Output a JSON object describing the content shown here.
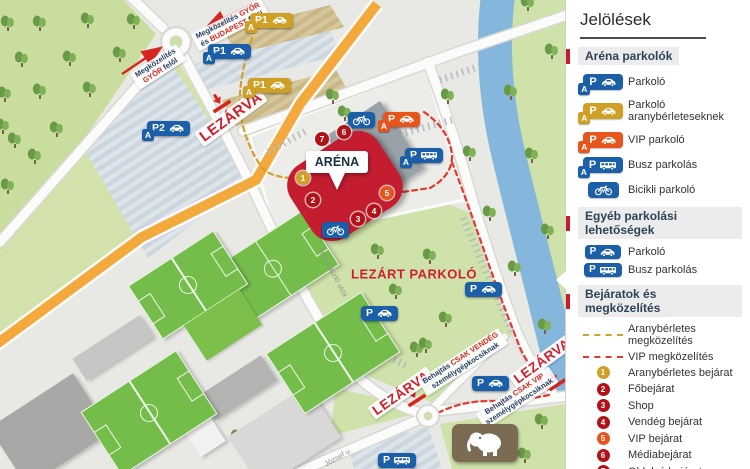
{
  "colors": {
    "blue": "#1a5fa8",
    "gold": "#d09f25",
    "orange": "#e8551c",
    "darkred": "#b01218",
    "red_text": "#cf1f2d",
    "river": "#84b7db",
    "grass": "#cfe2a9",
    "forest": "#c9dd9f",
    "road_orange": "#f3a93c",
    "brown": "#7b6b52"
  },
  "legend": {
    "title": "Jelölések",
    "sections": [
      {
        "header": "Aréna parkolók",
        "items": [
          {
            "type": "sign",
            "color": "blue",
            "p": "P",
            "glyph": "car",
            "badge": "A",
            "label": "Parkoló"
          },
          {
            "type": "sign",
            "color": "gold",
            "p": "P",
            "glyph": "car",
            "badge": "A",
            "label": "Parkoló aranybérleteseknek"
          },
          {
            "type": "sign",
            "color": "orange",
            "p": "P",
            "glyph": "car",
            "badge": "A",
            "label": "VIP parkoló"
          },
          {
            "type": "sign",
            "color": "blue",
            "p": "P",
            "glyph": "bus",
            "badge": "A",
            "label": "Busz parkolás"
          },
          {
            "type": "sign",
            "color": "blue",
            "p": "",
            "glyph": "bike",
            "badge": null,
            "label": "Bicikli parkoló"
          }
        ]
      },
      {
        "header": "Egyéb parkolási lehetőségek",
        "items": [
          {
            "type": "sign",
            "color": "blue",
            "p": "P",
            "glyph": "car",
            "badge": null,
            "label": "Parkoló"
          },
          {
            "type": "sign",
            "color": "blue",
            "p": "P",
            "glyph": "bus",
            "badge": null,
            "label": "Busz parkolás"
          }
        ]
      },
      {
        "header": "Bejáratok és megközelítés",
        "items": [
          {
            "type": "dash",
            "color": "gold",
            "label": "Aranybérletes megközelítés"
          },
          {
            "type": "dash",
            "color": "red",
            "label": "VIP megközelítés"
          },
          {
            "type": "num",
            "n": "1",
            "color": "gold",
            "label": "Aranybérletes bejárat"
          },
          {
            "type": "num",
            "n": "2",
            "color": "darkred",
            "label": "Főbejárat"
          },
          {
            "type": "num",
            "n": "3",
            "color": "darkred",
            "label": "Shop"
          },
          {
            "type": "num",
            "n": "4",
            "color": "darkred",
            "label": "Vendég bejárat"
          },
          {
            "type": "num",
            "n": "5",
            "color": "orange",
            "label": "VIP bejárat"
          },
          {
            "type": "num",
            "n": "6",
            "color": "darkred",
            "label": "Médiabejárat"
          },
          {
            "type": "num",
            "n": "7",
            "color": "darkred",
            "label": "Oldalsó bejárat"
          }
        ]
      }
    ]
  },
  "map": {
    "arena_label": "ARÉNA",
    "closed_parking_label": {
      "text": "LEZÁRT PARKOLÓ",
      "x": 414,
      "y": 274
    },
    "closed_road_labels": [
      {
        "text": "LEZÁRVA",
        "x": 231,
        "y": 117,
        "rot": -36,
        "size": 15
      },
      {
        "text": "LEZÁRVA",
        "x": 401,
        "y": 393,
        "rot": -35,
        "size": 13.5
      },
      {
        "text": "LEZÁRVA",
        "x": 542,
        "y": 361,
        "rot": -36,
        "size": 13.5
      }
    ],
    "approach_labels": [
      {
        "x": 230,
        "y": 25,
        "rot": -27,
        "lines": [
          [
            {
              "t": "Megközelítés "
            },
            {
              "t": "GYŐR",
              "red": true
            }
          ],
          [
            {
              "t": "és "
            },
            {
              "t": "BUDAPEST",
              "red": true
            },
            {
              "t": " felől"
            }
          ]
        ]
      },
      {
        "x": 158,
        "y": 67,
        "rot": -33,
        "lines": [
          [
            {
              "t": "Megközelítés"
            }
          ],
          [
            {
              "t": "GYŐR",
              "red": true
            },
            {
              "t": " felől"
            }
          ]
        ]
      }
    ],
    "entry_restriction_labels": [
      {
        "x": 463,
        "y": 362,
        "rot": -33,
        "lines": [
          [
            {
              "t": "Behajtás "
            },
            {
              "t": "CSAK VENDÉG",
              "red": true
            }
          ],
          [
            {
              "t": "személygépkocsiknak"
            }
          ]
        ]
      },
      {
        "x": 517,
        "y": 398,
        "rot": -33,
        "lines": [
          [
            {
              "t": "Behajtás "
            },
            {
              "t": "CSAK VIP",
              "red": true
            }
          ],
          [
            {
              "t": "személygépkocsiknak"
            }
          ]
        ]
      }
    ],
    "streets": [
      {
        "text": "Tóth László utca",
        "x": 333,
        "y": 272,
        "rot": 62
      },
      {
        "text": "József u.",
        "x": 338,
        "y": 457,
        "rot": -30
      }
    ],
    "parking_signs": [
      {
        "x": 250,
        "y": 13,
        "color": "gold",
        "text": "P1",
        "glyph": "car",
        "badge": "A"
      },
      {
        "x": 208,
        "y": 44,
        "color": "blue",
        "text": "P1",
        "glyph": "car",
        "badge": "A"
      },
      {
        "x": 248,
        "y": 78,
        "color": "gold",
        "text": "P1",
        "glyph": "car",
        "badge": "A"
      },
      {
        "x": 147,
        "y": 121,
        "color": "blue",
        "text": "P2",
        "glyph": "car",
        "badge": "A"
      },
      {
        "x": 383,
        "y": 112,
        "color": "orange",
        "text": "P",
        "glyph": "car",
        "badge": "A"
      },
      {
        "x": 405,
        "y": 148,
        "color": "blue",
        "text": "P",
        "glyph": "bus",
        "badge": "A"
      },
      {
        "x": 348,
        "y": 112,
        "color": "blue",
        "text": "",
        "glyph": "bike",
        "badge": null
      },
      {
        "x": 322,
        "y": 222,
        "color": "blue",
        "text": "",
        "glyph": "bike",
        "badge": null
      },
      {
        "x": 361,
        "y": 306,
        "color": "blue",
        "text": "P",
        "glyph": "car",
        "badge": null
      },
      {
        "x": 465,
        "y": 282,
        "color": "blue",
        "text": "P",
        "glyph": "car",
        "badge": null
      },
      {
        "x": 472,
        "y": 376,
        "color": "blue",
        "text": "P",
        "glyph": "car",
        "badge": null
      },
      {
        "x": 378,
        "y": 453,
        "color": "blue",
        "text": "P",
        "glyph": "bus",
        "badge": null
      }
    ],
    "entrance_markers": [
      {
        "n": "7",
        "x": 322,
        "y": 139,
        "color": "darkred"
      },
      {
        "n": "6",
        "x": 344,
        "y": 132,
        "color": "darkred"
      },
      {
        "n": "1",
        "x": 303,
        "y": 178,
        "color": "gold"
      },
      {
        "n": "2",
        "x": 313,
        "y": 200,
        "color": "darkred"
      },
      {
        "n": "3",
        "x": 358,
        "y": 219,
        "color": "darkred"
      },
      {
        "n": "4",
        "x": 374,
        "y": 211,
        "color": "darkred"
      },
      {
        "n": "5",
        "x": 387,
        "y": 193,
        "color": "orange"
      }
    ],
    "landmarks": [
      {
        "icon": "elephant",
        "x": 452,
        "y": 424
      }
    ],
    "trees": [
      [
        8,
        30
      ],
      [
        40,
        30
      ],
      [
        88,
        27
      ],
      [
        134,
        28
      ],
      [
        22,
        66
      ],
      [
        70,
        65
      ],
      [
        120,
        61
      ],
      [
        5,
        101
      ],
      [
        40,
        98
      ],
      [
        90,
        96
      ],
      [
        57,
        136
      ],
      [
        15,
        147
      ],
      [
        35,
        163
      ],
      [
        3,
        133
      ],
      [
        8,
        193
      ],
      [
        333,
        103
      ],
      [
        345,
        120
      ],
      [
        448,
        103
      ],
      [
        511,
        99
      ],
      [
        470,
        160
      ],
      [
        532,
        162
      ],
      [
        528,
        10
      ],
      [
        552,
        58
      ],
      [
        490,
        220
      ],
      [
        548,
        238
      ],
      [
        515,
        275
      ],
      [
        545,
        333
      ],
      [
        378,
        258
      ],
      [
        430,
        263
      ],
      [
        396,
        298
      ],
      [
        446,
        326
      ],
      [
        365,
        344
      ],
      [
        417,
        356
      ],
      [
        426,
        352
      ],
      [
        238,
        444
      ],
      [
        542,
        428
      ],
      [
        525,
        462
      ]
    ]
  }
}
